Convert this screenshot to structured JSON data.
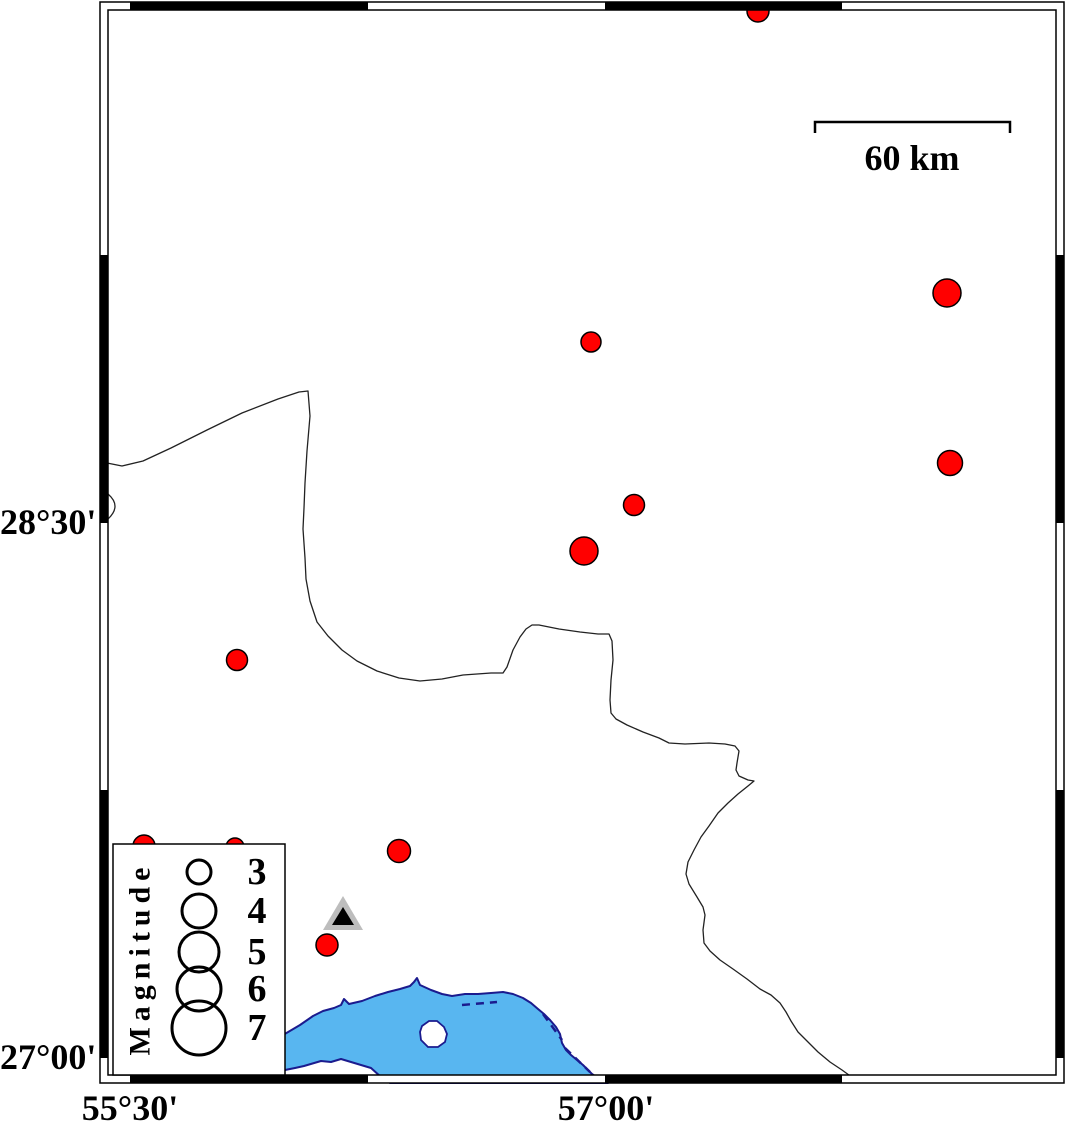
{
  "title": "Seismicity map with magnitude legend",
  "labels": {
    "lat_top": "28°30'",
    "lat_bottom": "27°00'",
    "lon_left": "55°30'",
    "lon_right": "57°00'"
  },
  "axis": {
    "lat_ticks": [
      {
        "text": "28°30'",
        "y": 523
      },
      {
        "text": "27°00'",
        "y": 1058
      }
    ],
    "lon_ticks": [
      {
        "text": "55°30'",
        "x": 130
      },
      {
        "text": "57°00'",
        "x": 606
      }
    ]
  },
  "frame": {
    "outer": {
      "x": 100,
      "y": 2,
      "w": 964,
      "h": 1081
    },
    "inner": {
      "x": 108,
      "y": 10,
      "w": 948,
      "h": 1065
    },
    "black_segments_x": [
      [
        130,
        368
      ],
      [
        605,
        842
      ]
    ],
    "black_segments_y": [
      [
        255,
        523
      ],
      [
        790,
        1058
      ]
    ]
  },
  "scale_bar": {
    "label": "60 km",
    "x1": 815,
    "x2": 1010,
    "y": 122,
    "tick_drop": 11,
    "label_x": 912,
    "label_y": 158
  },
  "legend": {
    "title": "Magnitude",
    "box": {
      "x": 113,
      "y": 844,
      "w": 172,
      "h": 231
    },
    "circle_x": 199,
    "number_x": 257,
    "items": [
      {
        "label": "3",
        "cy": 872,
        "r": 12
      },
      {
        "label": "4",
        "cy": 911,
        "r": 17
      },
      {
        "label": "5",
        "cy": 952,
        "r": 20
      },
      {
        "label": "6",
        "cy": 989,
        "r": 22
      },
      {
        "label": "7",
        "cy": 1028,
        "r": 27
      }
    ]
  },
  "earthquakes": [
    {
      "x": 758,
      "y": 11,
      "r": 11
    },
    {
      "x": 947,
      "y": 293,
      "r": 14
    },
    {
      "x": 591,
      "y": 342,
      "r": 10
    },
    {
      "x": 950,
      "y": 463,
      "r": 12.5
    },
    {
      "x": 634,
      "y": 505,
      "r": 10.5
    },
    {
      "x": 584,
      "y": 551,
      "r": 14
    },
    {
      "x": 237,
      "y": 660,
      "r": 10.5
    },
    {
      "x": 144,
      "y": 846,
      "r": 11
    },
    {
      "x": 235,
      "y": 847,
      "r": 9
    },
    {
      "x": 399,
      "y": 851,
      "r": 11.5
    },
    {
      "x": 327,
      "y": 945,
      "r": 11
    }
  ],
  "station": {
    "x": 343,
    "apex_y": 896,
    "base_y": 930,
    "half_w": 20,
    "inner_apex_y": 907,
    "inner_base_y": 925,
    "inner_half_w": 11
  },
  "colors": {
    "earthquake_fill": "#ff0000",
    "earthquake_stroke": "#000000",
    "water_fill": "#58b6f0",
    "water_stroke": "#1b1b8e",
    "land_line": "#222222",
    "station_gray": "#bdbdbd",
    "station_black": "#000000",
    "frame_black": "#000000"
  },
  "geography": {
    "border_main": "M107,463 L122,466 L143,461 L171,448 L207,430 L242,413 L278,399 L299,392 L308,391 L310,416 L307,451 L305,483 L304,508 L303,529 L305,558 L306,579 L310,601 L317,622 L328,636 L342,650 L357,661 L377,671 L399,678 L420,681 L442,679 L463,675 L491,673 L503,673 L507,667 L513,650 L520,637 L526,629 L532,625 L539,625 L559,629 L580,632 L598,634 L609,634 L612,641 L613,660 L611,680 L610,700 L611,713 L616,719 L627,725 L643,732 L659,738 L669,743 L685,744 L709,743 L725,744 L735,746 L739,751 L737,763 L736,770 L739,776 L748,780 L754,781 L748,786 L738,794 L728,803 L718,813 L709,826 L701,837 L694,850 L688,862 L686,874 L689,884 L697,897 L703,907 L705,915 L703,930 L704,943 L710,951 L720,960 L733,969 L747,979 L760,989 L771,995 L780,1003 L786,1012 L791,1021 L798,1032 L808,1042 L818,1052 L830,1062 L842,1070 L853,1078 L857,1083",
    "hook": "M108,494 Q122,506 108,519",
    "water": "M278,1038 L300,1025 L313,1016 L323,1011 L334,1008 L341,1005 L344,999 L349,1004 L362,1001 L375,996 L388,992 L400,989 L410,986 L414,982 L417,978 L420,985 L431,990 L442,994 L452,996 L465,994 L478,994 L491,993 L503,992 L513,994 L523,998 L531,1003 L538,1009 L544,1014 L550,1020 L556,1027 L560,1034 L562,1043 L566,1050 L571,1055 L577,1060 L583,1065 L588,1070 L592,1074 L598,1078 L604,1080 L608,1083 L390,1083 L381,1077 L371,1068 L361,1065 L351,1062 L341,1059 L331,1062 L321,1061 L304,1066 L295,1068 L285,1070 L278,1073 Z",
    "island": "M422,1026 L429,1021 L437,1021 L444,1027 L447,1034 L445,1042 L438,1047 L428,1047 L421,1040 L420,1032 Z",
    "coast_dashes": [
      "M462,1005 L497,1002",
      "M543,1014 L562,1040",
      "M565,1048 L590,1072"
    ]
  }
}
